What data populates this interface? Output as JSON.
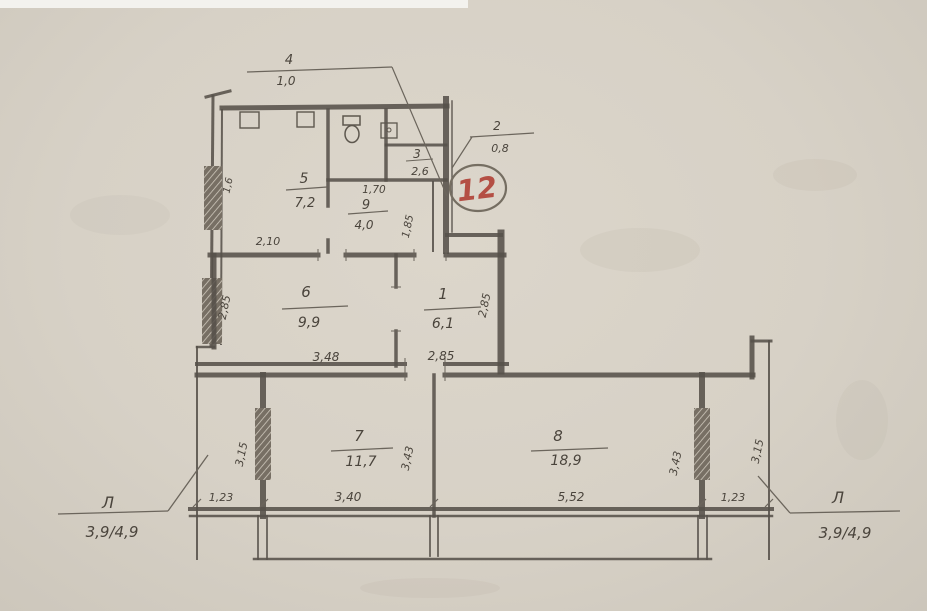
{
  "plan": {
    "apartment_number": "12",
    "rooms": {
      "r1": {
        "number": "1",
        "area": "6,1"
      },
      "r2": {
        "number": "2",
        "area": "0,8"
      },
      "r3": {
        "number": "3",
        "area": "2,6"
      },
      "r4": {
        "number": "4",
        "area": "1,0"
      },
      "r5": {
        "number": "5",
        "area": "7,2"
      },
      "r6": {
        "number": "6",
        "area": "9,9"
      },
      "r7": {
        "number": "7",
        "area": "11,7"
      },
      "r8": {
        "number": "8",
        "area": "18,9"
      },
      "r9": {
        "number": "9",
        "area": "4,0"
      }
    },
    "dims": {
      "room5_bottom": "2,10",
      "room5_window": "1,6",
      "room9_top": "1,70",
      "room9_side": "1,85",
      "room6_bottom": "3,48",
      "room6_side": "2,85",
      "room1_bottom": "2,85",
      "room1_side": "2,85",
      "room7_bottom": "3,40",
      "room7_left": "3,15",
      "room7_right": "3,43",
      "room8_bottom": "5,52",
      "room8_right": "3,43",
      "right_wall": "3,15",
      "loggia_left_depth": "1,23",
      "loggia_right_depth": "1,23"
    },
    "loggias": {
      "left": {
        "label": "Л",
        "size": "3,9/4,9"
      },
      "right": {
        "label": "Л",
        "size": "3,9/4,9"
      }
    },
    "colors": {
      "pencil": "#57514a",
      "paper": "#d7d1c6",
      "apartment_red": "#b44f44"
    }
  }
}
